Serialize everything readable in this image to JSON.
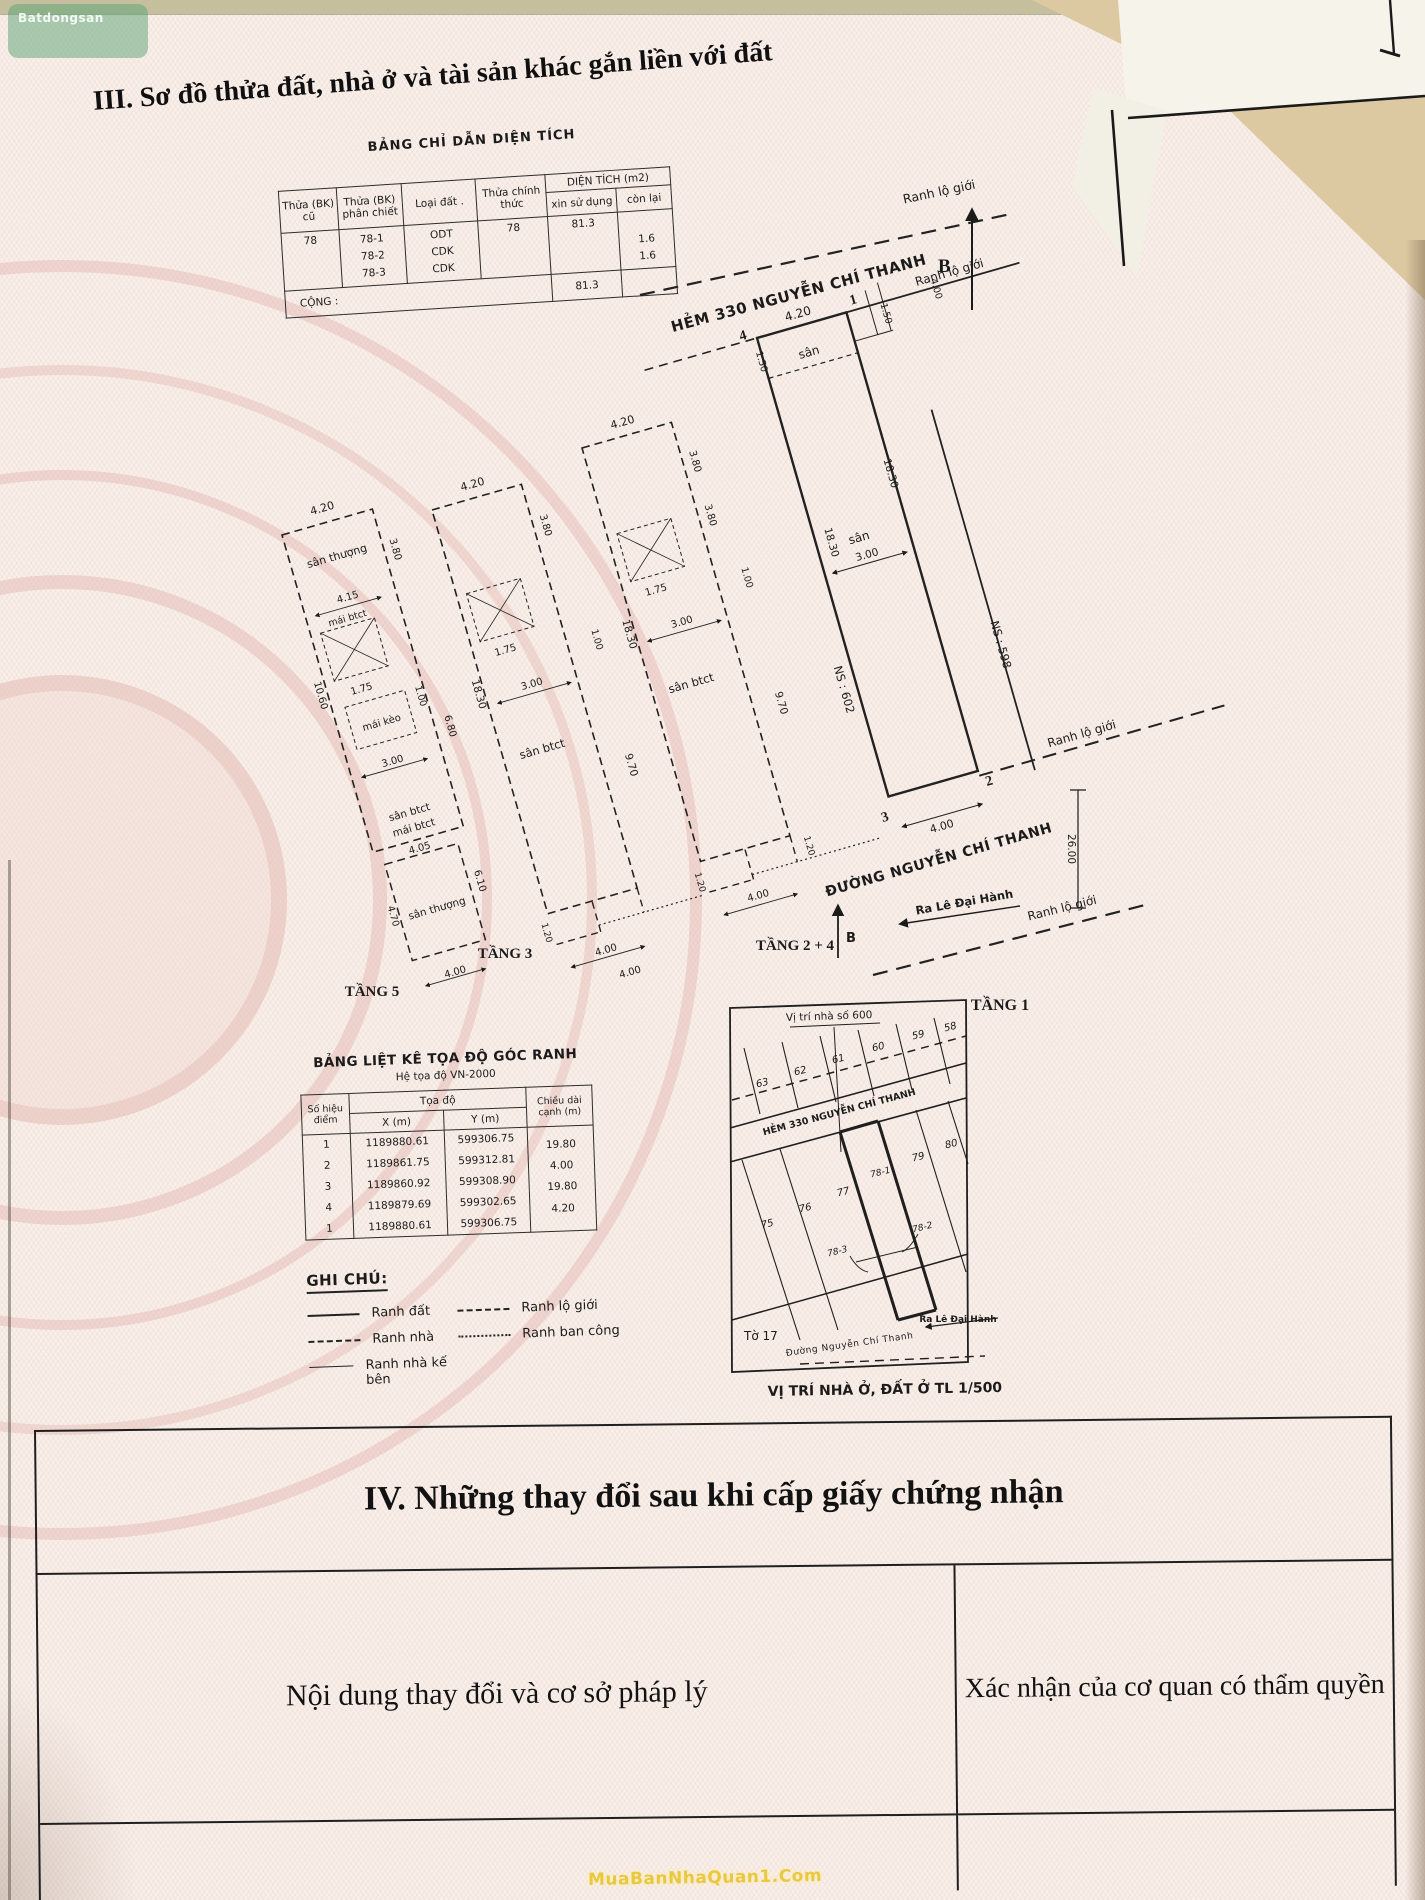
{
  "doc": {
    "section3_title": "III. Sơ đồ thửa đất, nhà ở và tài sản khác gắn liền với đất",
    "logo_watermark": "Batdongsan",
    "bottom_watermark": "MuaBanNhaQuan1.Com"
  },
  "area_table": {
    "title": "BẢNG CHỈ DẪN DIỆN TÍCH",
    "col_thua_cu": "Thửa (BK) cũ",
    "col_phan_chiet": "Thửa (BK) phân chiết",
    "col_loai_dat": "Loại đất .",
    "col_chinh_thuc": "Thửa chính thức",
    "col_dien_tich": "DIỆN TÍCH (m2)",
    "col_xin_su_dung": "xin sử dụng",
    "col_con_lai": "còn lại",
    "thua_cu": "78",
    "phan_chiet_1": "78-1",
    "phan_chiet_2": "78-2",
    "phan_chiet_3": "78-3",
    "loai_dat_1": "ODT",
    "loai_dat_2": "CDK",
    "loai_dat_3": "CDK",
    "chinh_thuc": "78",
    "xin_su_dung": "81.3",
    "con_lai_2": "1.6",
    "con_lai_3": "1.6",
    "cong_label": "CỘNG :",
    "cong_value": "81.3"
  },
  "plans": {
    "t1": {
      "name": "TẦNG 1",
      "hem": "HẺM 330  NGUYỄN CHÍ THANH",
      "duong": "ĐƯỜNG NGUYỄN CHÍ THANH",
      "ra_le_dai_hanh": "Ra Lê Đại Hành",
      "ranh_lo_gioi": "Ranh lộ giới",
      "san": "sân",
      "ns_trai": "NS : 602",
      "ns_phai": "NS : 598",
      "p1": "1",
      "p2": "2",
      "p3": "3",
      "p4": "4",
      "north": "B",
      "d420": "4.20",
      "d400": "4.00",
      "d150": "1.50",
      "d300": "3.00",
      "d1830": "18.30",
      "d2600": "26.00"
    },
    "t24": {
      "name": "TẦNG 2 + 4",
      "san": "sân btct",
      "d420": "4.20",
      "d380": "3.80",
      "d175": "1.75",
      "d100": "1.00",
      "d300": "3.00",
      "d1830": "18.30",
      "d970": "9.70",
      "d120": "1.20",
      "d400": "4.00"
    },
    "t3": {
      "name": "TẦNG 3",
      "san": "sân btct",
      "d420": "4.20",
      "d380": "3.80",
      "d175": "1.75",
      "d100": "1.00",
      "d300": "3.00",
      "d1830": "18.30",
      "d970": "9.70",
      "d120": "1.20",
      "d400": "4.00"
    },
    "t5": {
      "name": "TẦNG 5",
      "san_thuong": "sân thượng",
      "mai_btct": "mái btct",
      "mai_keo": "mái kèo",
      "san_btct": "sân btct",
      "d420": "4.20",
      "d380": "3.80",
      "d415": "4.15",
      "d175": "1.75",
      "d100": "1.00",
      "d300": "3.00",
      "d1060": "10.60",
      "d680": "6.80",
      "d405": "4.05",
      "d610": "6.10",
      "d470": "4.70",
      "d400": "4.00"
    }
  },
  "coord_table": {
    "title": "BẢNG LIỆT KÊ TỌA ĐỘ GÓC RANH",
    "subtitle": "Hệ tọa độ VN-2000",
    "col_point": "Số hiệu điểm",
    "col_group": "Tọa độ",
    "col_x": "X (m)",
    "col_y": "Y (m)",
    "col_len": "Chiều dài cạnh (m)",
    "rows": [
      {
        "p": "1",
        "x": "1189880.61",
        "y": "599306.75"
      },
      {
        "p": "2",
        "x": "1189861.75",
        "y": "599312.81"
      },
      {
        "p": "3",
        "x": "1189860.92",
        "y": "599308.90"
      },
      {
        "p": "4",
        "x": "1189879.69",
        "y": "599302.65"
      },
      {
        "p": "1",
        "x": "1189880.61",
        "y": "599306.75"
      }
    ],
    "lengths": [
      "19.80",
      "4.00",
      "19.80",
      "4.20"
    ]
  },
  "legend": {
    "title": "GHI CHÚ:",
    "ranh_dat": "Ranh đất",
    "ranh_nha": "Ranh nhà",
    "ranh_nha_ke_ben": "Ranh nhà kế bên",
    "ranh_lo_gioi": "Ranh lộ giới",
    "ranh_ban_cong": "Ranh ban công"
  },
  "map": {
    "top_label": "Vị trí nhà số 600",
    "hem": "HẺM 330  NGUYỄN CHÍ THANH",
    "to": "Tờ 17",
    "duong": "Đường Nguyễn Chí Thanh",
    "ra": "Ra Lê Đại Hành",
    "north": "B",
    "caption": "VỊ TRÍ NHÀ Ở, ĐẤT Ở TL 1/500",
    "lots_top": [
      "63",
      "62",
      "61",
      "60",
      "59",
      "58"
    ],
    "lots_bottom": [
      "75",
      "76",
      "77",
      "78-1",
      "79",
      "80"
    ],
    "lot_78_3": "78-3",
    "lot_78_2": "78-2"
  },
  "section4": {
    "title": "IV. Những thay đổi sau khi cấp giấy chứng nhận",
    "col_left": "Nội dung thay đổi và cơ sở pháp lý",
    "col_right": "Xác nhận của cơ quan có thẩm quyền"
  }
}
